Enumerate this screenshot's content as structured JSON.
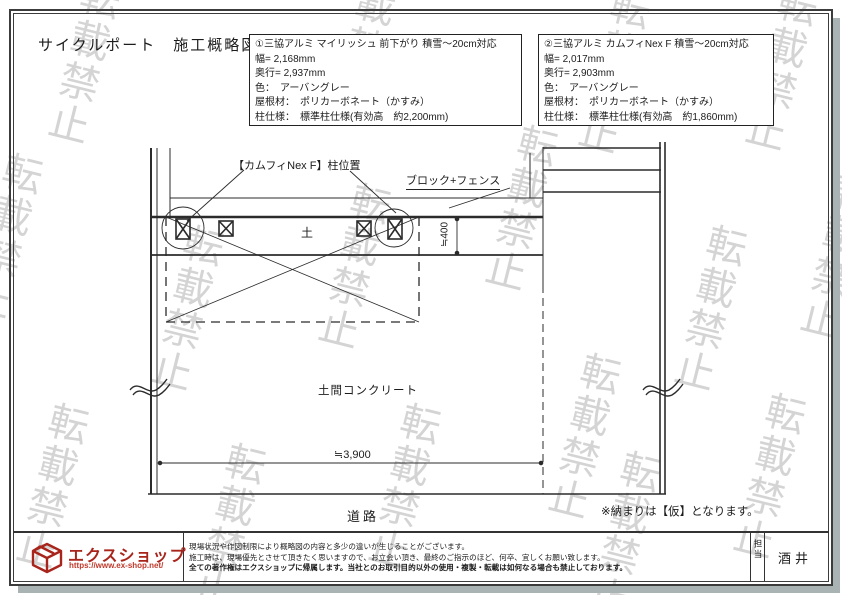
{
  "page": {
    "title": "サイクルポート　施工概略図",
    "watermark": "転載禁止"
  },
  "colors": {
    "brand_red": "#a8251c",
    "url_red": "#c0392b",
    "line_black": "#2b2b2b",
    "watermark_gray": "#9b9b9b",
    "shadow_gray": "#aab3b3"
  },
  "boxes": [
    {
      "lines": [
        "①三協アルミ マイリッシュ 前下がり 積雪～20cm対応",
        "幅= 2,168mm",
        "奥行= 2,937mm",
        "色：　アーバングレー",
        "屋根材：　ポリカーボネート（かすみ）",
        "柱仕様：　標準柱仕様(有効高　約2,200mm)"
      ]
    },
    {
      "lines": [
        "②三協アルミ カムフィNex F 積雪～20cm対応",
        "幅= 2,017mm",
        "奥行= 2,903mm",
        "色：　アーバングレー",
        "屋根材：　ポリカーボネート（かすみ）",
        "柱仕様：　標準柱仕様(有効高　約1,860mm)"
      ]
    }
  ],
  "drawing": {
    "pillar_position": "【カムフィNex F】柱位置",
    "block_fence": "ブロック+フェンス",
    "soil": "土",
    "dim_depth": "≒400",
    "concrete": "土間コンクリート",
    "dim_width": "≒3,900",
    "road": "道路",
    "note": "※納まりは【仮】となります。"
  },
  "footer": {
    "brand": "エクスショップ",
    "url": "https://www.ex-shop.net/",
    "disclaimer": [
      "現場状況や作図制限により概略図の内容と多少の違いが生じることがございます。",
      "施工時は、現場優先とさせて頂きたく思いますので、お立会い頂き、最終のご指示のほど、何卒、宜しくお願い致します。",
      "全ての著作権はエクスショップに帰属します。当社とのお取引目的以外の使用・複製・転載は如何なる場合も禁止しております。"
    ],
    "staff_label": "担当",
    "staff_name": "酒井"
  }
}
